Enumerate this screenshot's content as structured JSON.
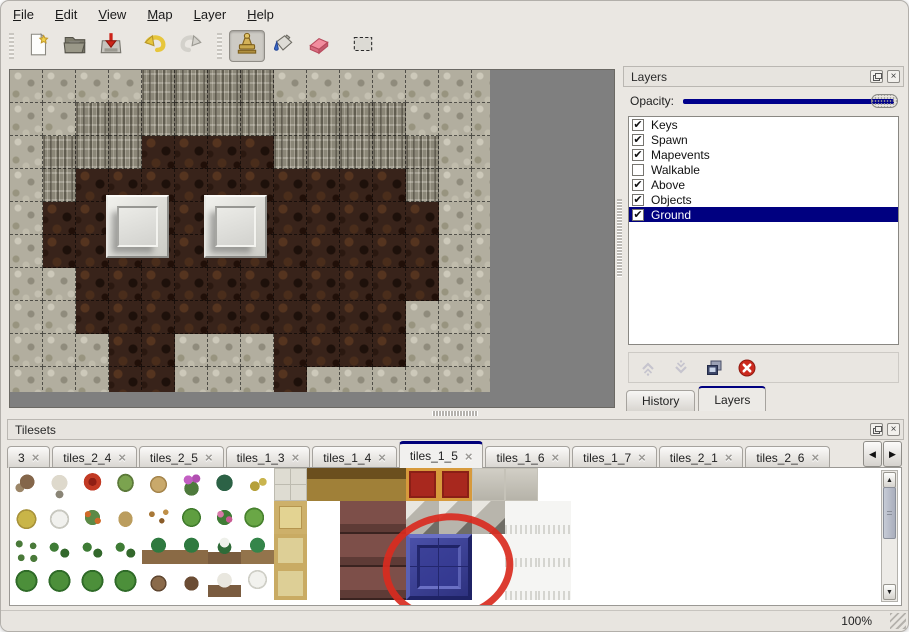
{
  "menu": {
    "items": [
      {
        "label": "File"
      },
      {
        "label": "Edit"
      },
      {
        "label": "View"
      },
      {
        "label": "Map"
      },
      {
        "label": "Layer"
      },
      {
        "label": "Help"
      }
    ]
  },
  "toolbar": {
    "tools": [
      {
        "name": "new-file"
      },
      {
        "name": "open-file"
      },
      {
        "name": "save-file"
      },
      {
        "name": "undo"
      },
      {
        "name": "redo"
      },
      {
        "name": "stamp-tool",
        "selected": true
      },
      {
        "name": "fill-tool"
      },
      {
        "name": "eraser-tool"
      },
      {
        "name": "selection-tool"
      }
    ]
  },
  "layers_panel": {
    "title": "Layers",
    "opacity_label": "Opacity:",
    "opacity_fraction": 1,
    "layers": [
      {
        "name": "Keys",
        "checked": true,
        "selected": false
      },
      {
        "name": "Spawn",
        "checked": true,
        "selected": false
      },
      {
        "name": "Mapevents",
        "checked": true,
        "selected": false
      },
      {
        "name": "Walkable",
        "checked": false,
        "selected": false
      },
      {
        "name": "Above",
        "checked": true,
        "selected": false
      },
      {
        "name": "Objects",
        "checked": true,
        "selected": false
      },
      {
        "name": "Ground",
        "checked": true,
        "selected": true
      }
    ],
    "buttons": [
      {
        "name": "move-layer-up",
        "enabled": false
      },
      {
        "name": "move-layer-down",
        "enabled": false
      },
      {
        "name": "duplicate-layer",
        "enabled": true
      },
      {
        "name": "delete-layer",
        "enabled": true
      }
    ],
    "tabs": [
      {
        "label": "History",
        "active": false
      },
      {
        "label": "Layers",
        "active": true
      }
    ]
  },
  "tilesets_panel": {
    "title": "Tilesets",
    "tabs": [
      {
        "label": "3",
        "active": false,
        "clipped": true
      },
      {
        "label": "tiles_2_4",
        "active": false
      },
      {
        "label": "tiles_2_5",
        "active": false
      },
      {
        "label": "tiles_1_3",
        "active": false
      },
      {
        "label": "tiles_1_4",
        "active": false
      },
      {
        "label": "tiles_1_5",
        "active": true
      },
      {
        "label": "tiles_1_6",
        "active": false
      },
      {
        "label": "tiles_1_7",
        "active": false
      },
      {
        "label": "tiles_2_1",
        "active": false
      },
      {
        "label": "tiles_2_6",
        "active": false
      }
    ],
    "tile_legend": {
      "t1": "bare-tree",
      "t2": "white-coral-tree",
      "rf": "red-flower-bush",
      "st": "tree-stump",
      "tr": "tree-trunk",
      "pf": "purple-flowers",
      "fn": "fern",
      "yp": "yellow-plant",
      "hm": "hay-mound",
      "sm": "snow-mound",
      "of": "orange-flowers",
      "tg": "dry-grass",
      "lv": "fallen-leaves",
      "lp": "lily-pad",
      "rb": "rose-bush",
      "lp2": "lily-pad-2",
      "sg": "sprigs",
      "gs": "green-shrub",
      "pm": "palm-tree",
      "spp": "snowy-palm",
      "pm2": "palm-tree-2",
      "gb": "bushy-tree",
      "tt": "twisted-trunk",
      "dt": "dark-trunk",
      "wt": "winter-tree",
      "wp2": "snow-pine",
      "stone": "stone-floor",
      "tan": "tan-floor",
      "tan2": "tan-floor-large",
      "wood": "wooden-table",
      "dred": "maroon-furniture",
      "rcar": "red-carpet",
      "gray": "gray-floor",
      "g3d": "gray-blocks",
      "wfur": "white-fur-rug",
      "blu": "blue-tile-selected",
      "wht": "empty"
    },
    "grid": [
      [
        "t1",
        "t2",
        "rf",
        "st",
        "tr",
        "pf",
        "fn",
        "yp",
        "stone",
        "wood",
        "wood",
        "wood",
        "rcar",
        "rcar",
        "gray",
        "gray",
        "wht",
        "wht"
      ],
      [
        "hm",
        "sm",
        "of",
        "tg",
        "lv",
        "lp",
        "rb",
        "lp2",
        "tan",
        "wht",
        "dred",
        "dred",
        "g3d",
        "g3d",
        "g3d",
        "wfur",
        "wfur",
        "wht"
      ],
      [
        "sg",
        "gs",
        "gs",
        "gs",
        "pm",
        "pm",
        "spp",
        "pm2",
        "tan2",
        "wht",
        "dred",
        "dred",
        "blu",
        "blu",
        "wht",
        "wfur",
        "wfur",
        "wht"
      ],
      [
        "gb",
        "gb",
        "gb",
        "gb",
        "tt",
        "dt",
        "wt",
        "wp2",
        "tan2",
        "wht",
        "dred",
        "dred",
        "blu",
        "blu",
        "wht",
        "wfur",
        "wfur",
        "wht"
      ]
    ],
    "annotation": {
      "shape": "ellipse",
      "color": "#d92b20",
      "around": "blue-tile"
    }
  },
  "map_view": {
    "legend": {
      "L": "light-rock",
      "D": "cliff-rock",
      "G": "dark-ground"
    },
    "rows": [
      "LLLLDDDDLLLLLLL",
      "LLDDDDDDDDDDLLL",
      "LDDDGGGGDDDDDLL",
      "LDGGGGGGGGGGDLL",
      "LGGGGGGGGGGGGLL",
      "LGGGGGGGGGGGGLL",
      "LLGGGGGGGGGGGLL",
      "LLGGGGGGGGGGLLL",
      "LLLGGLLLGGGGLLL",
      "LLLGGLLLGLLLLLL"
    ],
    "pedestals": [
      {
        "x": 96,
        "y": 125
      },
      {
        "x": 194,
        "y": 125
      }
    ]
  },
  "status_bar": {
    "zoom_level": "100%"
  },
  "colors": {
    "selection": "#000080",
    "slider_fill": "#00008b",
    "annotation": "#d92b20",
    "canvas_bg": "#7f7f7f"
  }
}
